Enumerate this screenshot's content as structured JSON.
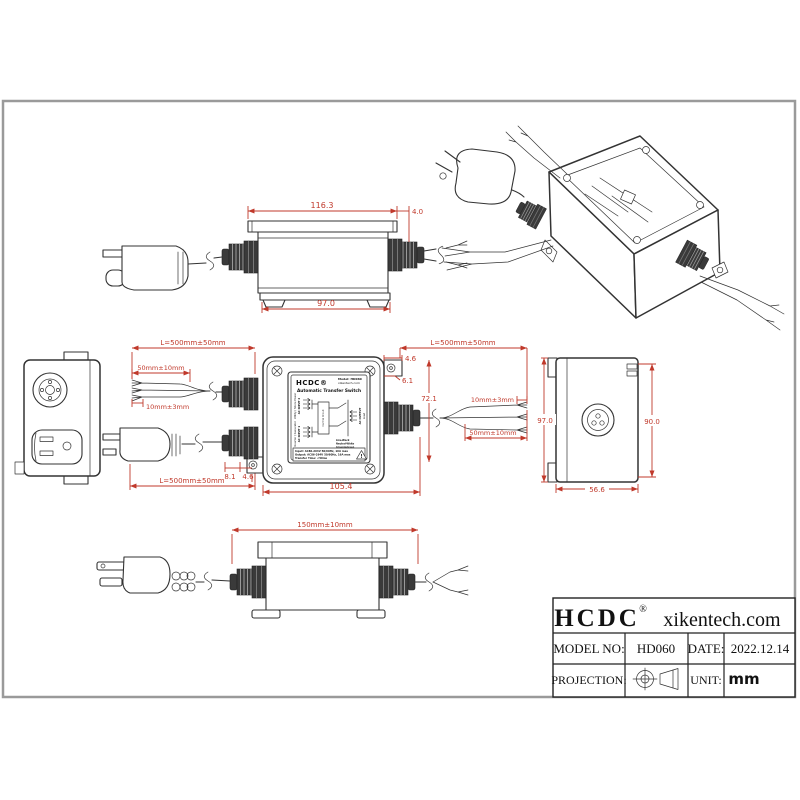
{
  "colors": {
    "line": "#333333",
    "dimension": "#c0392b",
    "frame": "#9a9a9a"
  },
  "title_block": {
    "brand": "HCDC",
    "registered": "®",
    "website": "xikentech.com",
    "model_label": "MODEL NO:",
    "model_value": "HD060",
    "date_label": "DATE:",
    "date_value": "2022.12.14",
    "projection_label": "PROJECTION:",
    "unit_label": "UNIT:",
    "unit_value": "mm"
  },
  "device_label": {
    "brand": "HCDC®",
    "model": "Model: HD060",
    "website": "xikentech.com",
    "product": "Automatic Transfer Switch",
    "input2_line1": "Utility / Shore Power",
    "input2_line2": "AC INPUT 2",
    "input1_line1": "Inverter / Generator",
    "input1_line2": "AC INPUT 1",
    "output_line1": "AC OUTPUT",
    "output_line2": "Load",
    "control": "Control Circuit",
    "wire1": "Line-Black",
    "wire2": "Neutral-White",
    "wire3": "Ground-Green",
    "spec1": "Input: AC86-264V 50/60Hz, 16A max",
    "spec2": "Output: AC86-264V 50/60Hz, 16A max",
    "spec3": "Transfer Time: <50ms",
    "warning": "!"
  },
  "dimensions": {
    "top_view": {
      "flange_width": "116.3",
      "lip_offset": "4.0",
      "base_width": "97.0"
    },
    "front_view": {
      "tab_width_top": "4.6",
      "hole_offset_top": "6.1",
      "gland_height": "72.1",
      "tab_offset_bottom": "8.1",
      "tab_width_bottom": "4.6",
      "overall_width": "105.4"
    },
    "cables": {
      "input2_length": "L=500mm±50mm",
      "input1_length": "L=500mm±50mm",
      "output_length": "L=500mm±50mm",
      "strip_left": "50mm±10mm",
      "tin_left": "10mm±3mm",
      "tin_right": "10mm±3mm",
      "strip_right": "50mm±10mm",
      "plug_cord_length": "150mm±10mm"
    },
    "side_view": {
      "height_overall": "97.0",
      "height_body": "90.0",
      "depth": "56.6"
    }
  }
}
